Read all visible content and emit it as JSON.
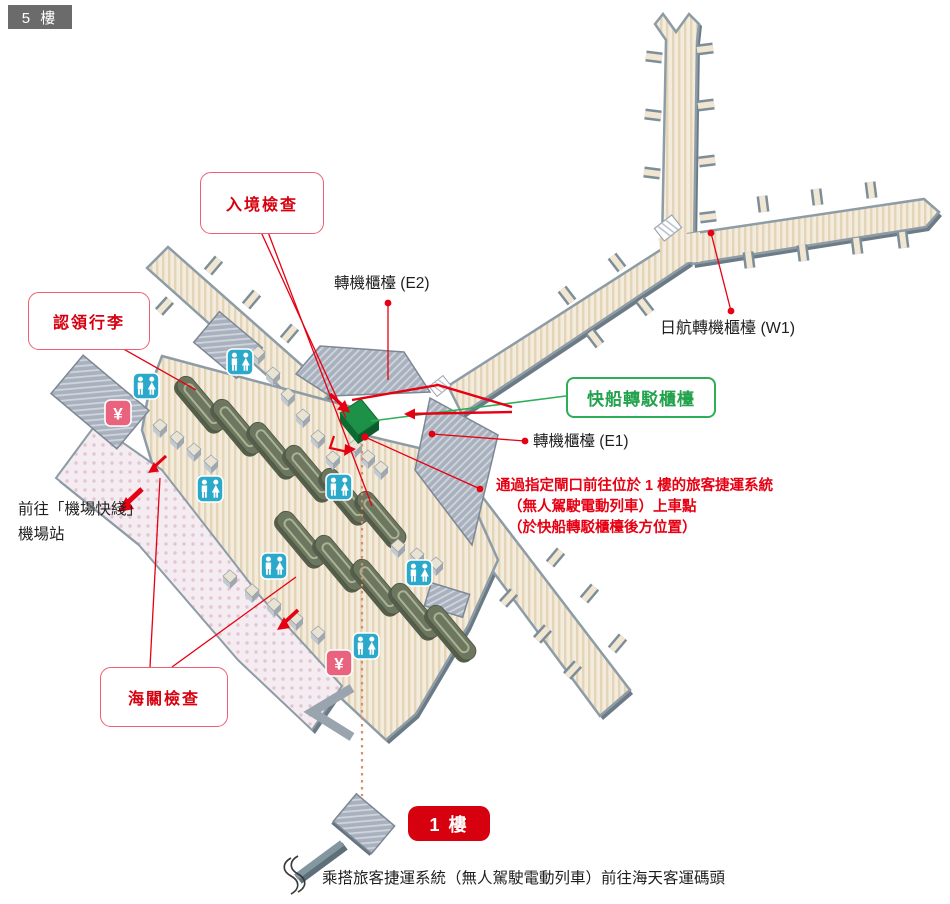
{
  "floor_badge": "5 樓",
  "labels": {
    "immigration": "入境檢查",
    "baggage_claim": "認領行李",
    "customs": "海關檢查",
    "ferry_transfer": "快船轉駁櫃檯",
    "transfer_e2": "轉機櫃檯 (E2)",
    "transfer_e1": "轉機櫃檯 (E1)",
    "jal_transfer_w1": "日航轉機櫃檯 (W1)",
    "airport_express_line1": "前往「機場快綫」",
    "airport_express_line2": "機場站",
    "apm_note_line1": "通過指定閘口前往位於 1 樓的旅客捷運系統",
    "apm_note_line2": "（無人駕駛電動列車）上車點",
    "apm_note_line3": "（於快船轉駁櫃檯後方位置）",
    "floor1_badge": "1 樓",
    "bottom_note": "乘搭旅客捷運系統（無人駕駛電動列車）前往海天客運碼頭",
    "yen_symbol": "¥"
  },
  "icons": [
    {
      "name": "toilet-icon",
      "meaning": "toilets (men/women)",
      "color": "#2ba9cb"
    },
    {
      "name": "currency-exchange-icon",
      "meaning": "money exchange",
      "glyph": "¥",
      "color": "#e9637f"
    },
    {
      "name": "escalator-icon",
      "meaning": "escalator"
    },
    {
      "name": "ferry-counter-marker",
      "meaning": "ferry transfer counter",
      "color": "#1d9148"
    }
  ],
  "colors": {
    "accent_red": "#e60012",
    "label_red": "#d7000f",
    "label_green": "#23a24d",
    "corridor_beige": "#f3ebdb",
    "wall_gray": "#8d9ca6",
    "platform_gray": "#a8b1bd",
    "walkway_pink": "#f5ecf1",
    "carousel_olive": "#6d765f",
    "badge_gray": "#6b6b6b",
    "badge_red": "#d7000f",
    "dotted_route": "#d98c6a"
  }
}
